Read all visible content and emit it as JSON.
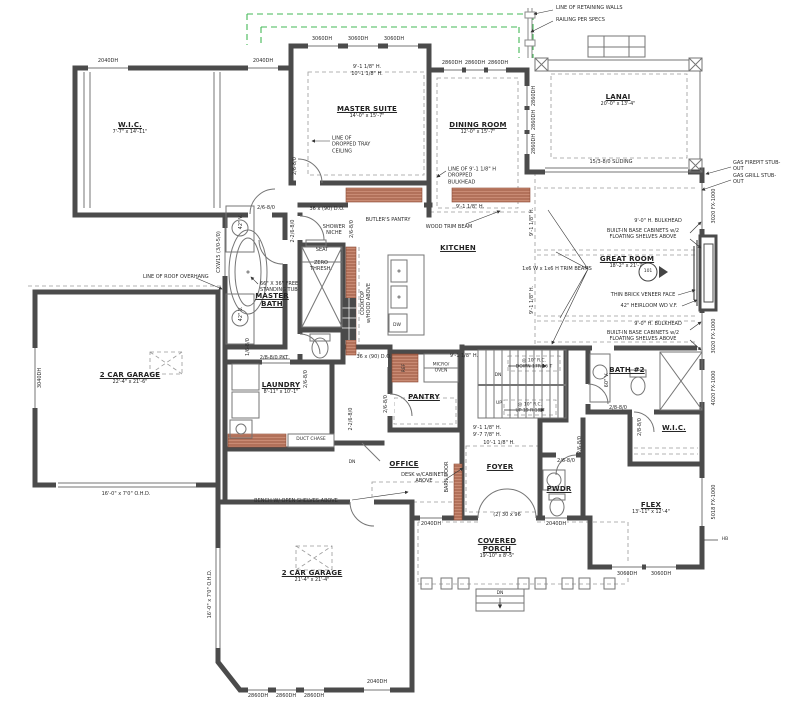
{
  "drawing": {
    "type_label": "first-floor-plan"
  },
  "colors": {
    "wall": "#4b4b4b",
    "thin": "#757575",
    "dash": "#9a9a9a",
    "green_dash": "#43b957",
    "cabinet_red": "#c98b74",
    "cabinet_red_dark": "#8e4a33"
  },
  "rooms": [
    {
      "id": "wic-1",
      "name": "W.I.C.",
      "dims": "7'-7\" x 14'-11\"",
      "x": 130,
      "y": 128
    },
    {
      "id": "master-suite",
      "name": "MASTER SUITE",
      "dims": "14'-0\" x 15'-7\"",
      "x": 367,
      "y": 112
    },
    {
      "id": "dining-room",
      "name": "DINING ROOM",
      "dims": "12'-0\" x 15'-7\"",
      "x": 478,
      "y": 128
    },
    {
      "id": "lanai",
      "name": "LANAI",
      "dims": "20'-0\" x 13'-4\"",
      "x": 618,
      "y": 100
    },
    {
      "id": "master-bath",
      "name": "MASTER\nBATH",
      "dims": "",
      "x": 272,
      "y": 300
    },
    {
      "id": "kitchen",
      "name": "KITCHEN",
      "dims": "",
      "x": 458,
      "y": 248
    },
    {
      "id": "great-room",
      "name": "GREAT ROOM",
      "dims": "18'-2\" x 21'-7\"",
      "x": 627,
      "y": 262
    },
    {
      "id": "garage-left",
      "name": "2 CAR GARAGE",
      "dims": "22'-4\" x 21'-6\"",
      "x": 130,
      "y": 378
    },
    {
      "id": "laundry",
      "name": "LAUNDRY",
      "dims": "8'-11\" x 10'-1\"",
      "x": 281,
      "y": 388
    },
    {
      "id": "pantry",
      "name": "PANTRY",
      "dims": "",
      "x": 424,
      "y": 397
    },
    {
      "id": "office",
      "name": "OFFICE",
      "dims": "",
      "x": 404,
      "y": 464
    },
    {
      "id": "foyer",
      "name": "FOYER",
      "dims": "",
      "x": 500,
      "y": 467
    },
    {
      "id": "pwdr",
      "name": "PWDR",
      "dims": "",
      "x": 559,
      "y": 489
    },
    {
      "id": "bath-2",
      "name": "BATH #2",
      "dims": "",
      "x": 627,
      "y": 370
    },
    {
      "id": "wic-2",
      "name": "W.I.C.",
      "dims": "",
      "x": 674,
      "y": 428
    },
    {
      "id": "flex",
      "name": "FLEX",
      "dims": "13'-11\" x 12'-4\"",
      "x": 651,
      "y": 508
    },
    {
      "id": "garage-bottom",
      "name": "2 CAR GARAGE",
      "dims": "21'-4\" x 21'-4\"",
      "x": 312,
      "y": 576
    },
    {
      "id": "covered-porch",
      "name": "COVERED\nPORCH",
      "dims": "19'-10\" x 8'-5\"",
      "x": 497,
      "y": 548
    }
  ],
  "annotations": [
    {
      "n": "note-retaining-walls",
      "t": "LINE OF RETAINING WALLS",
      "x": 556,
      "y": 8,
      "a": "l"
    },
    {
      "n": "note-railing",
      "t": "RAILING PER SPECS",
      "x": 556,
      "y": 20,
      "a": "l"
    },
    {
      "n": "note-gas-firepit",
      "t": "GAS FIREPIT STUB-OUT",
      "x": 733,
      "y": 166,
      "a": "l"
    },
    {
      "n": "note-gas-grill",
      "t": "GAS GRILL STUB-OUT",
      "x": 733,
      "y": 179,
      "a": "l"
    },
    {
      "n": "tag-sliding-door",
      "t": "15/3-8/0 SLIDING",
      "x": 611,
      "y": 162
    },
    {
      "n": "note-roof-overhang",
      "t": "LINE OF ROOF OVERHANG",
      "x": 143,
      "y": 277,
      "a": "l"
    },
    {
      "n": "note-tray-ceiling",
      "t": "LINE OF\nDROPPED TRAY\nCEILING",
      "x": 332,
      "y": 145,
      "a": "l"
    },
    {
      "n": "note-dropped-bulkhead",
      "t": "LINE OF 9'-1 1/8\" H\nDROPPED\nBULKHEAD",
      "x": 448,
      "y": 176,
      "a": "l"
    },
    {
      "n": "note-butlers-pantry",
      "t": "BUTLER'S PANTRY",
      "x": 388,
      "y": 220
    },
    {
      "n": "note-wood-trim-beam",
      "t": "WOOD TRIM BEAM",
      "x": 449,
      "y": 227
    },
    {
      "n": "note-shower-niche",
      "t": "SHOWER\nNICHE",
      "x": 334,
      "y": 230
    },
    {
      "n": "note-seat",
      "t": "SEAT",
      "x": 322,
      "y": 250
    },
    {
      "n": "note-zero-thresh",
      "t": "ZERO\nTHRESH.",
      "x": 321,
      "y": 266
    },
    {
      "n": "note-free-standing-tub",
      "t": "66\" X 36\" FREE\nSTANDING TUB",
      "x": 260,
      "y": 287,
      "a": "l"
    },
    {
      "n": "note-trim-beams",
      "t": "1x6 W x 1x6 H TRIM BEAMS",
      "x": 557,
      "y": 269
    },
    {
      "n": "note-bulkhead-1",
      "t": "9'-0\" H. BULKHEAD",
      "x": 658,
      "y": 221
    },
    {
      "n": "note-builtin-1",
      "t": "BUILT-IN BASE CABINETS w/2\nFLOATING SHELVES ABOVE",
      "x": 643,
      "y": 234
    },
    {
      "n": "note-thin-brick",
      "t": "THIN BRICK VENEER FACE",
      "x": 643,
      "y": 295
    },
    {
      "n": "note-heirloom-fireplace",
      "t": "42\" HEIRLOOM WD V.F.",
      "x": 649,
      "y": 306
    },
    {
      "n": "note-bulkhead-2",
      "t": "9'-0\" H. BULKHEAD",
      "x": 658,
      "y": 324
    },
    {
      "n": "note-builtin-2",
      "t": "BUILT-IN BASE CABINETS w/2\nFLOATING SHELVES ABOVE",
      "x": 643,
      "y": 336
    },
    {
      "n": "note-cooktop",
      "t": "COOKTOP\nw/HOOD ABOVE",
      "x": 366,
      "y": 303,
      "r": 1
    },
    {
      "n": "tag-dw",
      "t": "DW",
      "x": 397,
      "y": 326,
      "s": 4.5
    },
    {
      "n": "note-duct-chase",
      "t": "DUCT CHASE",
      "x": 311,
      "y": 440,
      "s": 4.5
    },
    {
      "n": "tag-ref",
      "t": "REF",
      "x": 405,
      "y": 368,
      "r": 1,
      "s": 4.5
    },
    {
      "n": "tag-micro-oven",
      "t": "MICRO/\nOVEN",
      "x": 441,
      "y": 368,
      "s": 4.5
    },
    {
      "n": "note-desk",
      "t": "DESK w/CABINETS\nABOVE",
      "x": 424,
      "y": 478
    },
    {
      "n": "note-bench",
      "t": "BENCH W/ OPEN SHELVES ABOVE",
      "x": 296,
      "y": 501
    },
    {
      "n": "note-barn-door",
      "t": "BARN DOOR",
      "x": 447,
      "y": 477,
      "r": 1
    },
    {
      "n": "tag-dn-step",
      "t": "DN",
      "x": 352,
      "y": 463,
      "s": 4.5
    },
    {
      "n": "tag-stair-dn",
      "t": "DN",
      "x": 498,
      "y": 376,
      "s": 4.5
    },
    {
      "n": "tag-stair-up",
      "t": "UP",
      "x": 499,
      "y": 404,
      "s": 4.5
    },
    {
      "n": "note-stair-down",
      "t": "@ 10\" R.C.\nDOWN 17R 16 T",
      "x": 534,
      "y": 364,
      "s": 4.5
    },
    {
      "n": "note-stair-up",
      "t": "@ 10\" R.C.\nUP 19 R 18 T",
      "x": 530,
      "y": 408,
      "s": 4.5
    },
    {
      "n": "tag-porch-dn",
      "t": "DN",
      "x": 500,
      "y": 594,
      "s": 4.5
    },
    {
      "n": "tag-hose-bib",
      "t": "HB",
      "x": 725,
      "y": 540,
      "s": 4.5
    },
    {
      "n": "tag-window-101",
      "t": "101",
      "x": 648,
      "y": 272,
      "s": 4.5
    },
    {
      "n": "height-1",
      "t": "9'-1 1/8\" H.",
      "x": 367,
      "y": 67
    },
    {
      "n": "height-2",
      "t": "10'-1 1/8\" H.",
      "x": 367,
      "y": 74
    },
    {
      "n": "height-3",
      "t": "9'-1 1/8\" H.",
      "x": 470,
      "y": 207
    },
    {
      "n": "height-4",
      "t": "9'-1 1/8\" H.",
      "x": 532,
      "y": 222,
      "r": 1
    },
    {
      "n": "height-5",
      "t": "9'-1 1/8\" H.",
      "x": 532,
      "y": 300,
      "r": 1
    },
    {
      "n": "height-6",
      "t": "9'-1 1/8\" H.",
      "x": 464,
      "y": 356
    },
    {
      "n": "height-7",
      "t": "9'-1 1/8\" H.",
      "x": 487,
      "y": 428
    },
    {
      "n": "height-8",
      "t": "9'-7 7/8\" H.",
      "x": 487,
      "y": 435
    },
    {
      "n": "height-9",
      "t": "10'-1 1/8\" H.",
      "x": 499,
      "y": 443
    },
    {
      "n": "tag-ohd-1",
      "t": "16'-0\" x 7'0\" O.H.D.",
      "x": 126,
      "y": 494
    },
    {
      "n": "tag-ohd-2",
      "t": "16'-0\" x 7'0\" O.H.D.",
      "x": 210,
      "y": 594,
      "r": 1
    },
    {
      "n": "tag-vanity-42-1",
      "t": "42\" V.",
      "x": 241,
      "y": 222,
      "r": 1
    },
    {
      "n": "tag-vanity-42-2",
      "t": "42\" V.",
      "x": 241,
      "y": 314,
      "r": 1
    },
    {
      "n": "tag-vanity-60",
      "t": "60\" V.",
      "x": 607,
      "y": 380,
      "r": 1
    },
    {
      "n": "tag-window-cxw",
      "t": "CXW15 (3/0-5/0)",
      "x": 219,
      "y": 252,
      "r": 1
    },
    {
      "n": "win-2040-a",
      "t": "2040DH",
      "x": 108,
      "y": 61
    },
    {
      "n": "win-2040-b",
      "t": "2040DH",
      "x": 263,
      "y": 61
    },
    {
      "n": "win-3060-a",
      "t": "3060DH",
      "x": 322,
      "y": 39
    },
    {
      "n": "win-3060-b",
      "t": "3060DH",
      "x": 358,
      "y": 39
    },
    {
      "n": "win-3060-c",
      "t": "3060DH",
      "x": 394,
      "y": 39
    },
    {
      "n": "win-2860-a",
      "t": "2860DH",
      "x": 452,
      "y": 63
    },
    {
      "n": "win-2860-b",
      "t": "2860DH",
      "x": 475,
      "y": 63
    },
    {
      "n": "win-2860-c",
      "t": "2860DH",
      "x": 498,
      "y": 63
    },
    {
      "n": "win-2860-d",
      "t": "2860DH",
      "x": 534,
      "y": 96,
      "r": 1
    },
    {
      "n": "win-2860-e",
      "t": "2860DH",
      "x": 534,
      "y": 120,
      "r": 1
    },
    {
      "n": "win-2860-f",
      "t": "2860DH",
      "x": 534,
      "y": 144,
      "r": 1
    },
    {
      "n": "win-3040",
      "t": "3040DH",
      "x": 40,
      "y": 378,
      "r": 1
    },
    {
      "n": "win-2040-c",
      "t": "2040DH",
      "x": 431,
      "y": 524
    },
    {
      "n": "win-2040-d",
      "t": "2040DH",
      "x": 556,
      "y": 524
    },
    {
      "n": "door-front",
      "t": "(2) 30 x 96",
      "x": 507,
      "y": 515
    },
    {
      "n": "win-2040-e",
      "t": "2040DH",
      "x": 377,
      "y": 682
    },
    {
      "n": "win-2860-g",
      "t": "2860DH",
      "x": 258,
      "y": 696
    },
    {
      "n": "win-2860-h",
      "t": "2860DH",
      "x": 286,
      "y": 696
    },
    {
      "n": "win-2860-i",
      "t": "2860DH",
      "x": 314,
      "y": 696
    },
    {
      "n": "win-3060-d",
      "t": "3060DH",
      "x": 627,
      "y": 574
    },
    {
      "n": "win-3060-e",
      "t": "3060DH",
      "x": 661,
      "y": 574
    },
    {
      "n": "win-3020-fx-1",
      "t": "3020 FX-1000",
      "x": 714,
      "y": 206,
      "r": 1
    },
    {
      "n": "win-3020-fx-2",
      "t": "3020 FX-1000",
      "x": 714,
      "y": 336,
      "r": 1
    },
    {
      "n": "win-4020-fx",
      "t": "4020 FX-1000",
      "x": 714,
      "y": 388,
      "r": 1
    },
    {
      "n": "win-5018-fx",
      "t": "5018 FX-1000",
      "x": 714,
      "y": 502,
      "r": 1
    },
    {
      "n": "door-wic1",
      "t": "2/6-8/0",
      "x": 266,
      "y": 208
    },
    {
      "n": "door-hall-1",
      "t": "2-2/6-8/0",
      "x": 293,
      "y": 231,
      "r": 1
    },
    {
      "n": "door-hall-2",
      "t": "2/6-8/0",
      "x": 352,
      "y": 229,
      "r": 1
    },
    {
      "n": "door-butler-opening",
      "t": "36 x (90) D.O.",
      "x": 327,
      "y": 209
    },
    {
      "n": "door-mud-opening",
      "t": "36 x (90) D.O.",
      "x": 374,
      "y": 357
    },
    {
      "n": "door-laundry-pkt",
      "t": "2/8-8/0 PKT",
      "x": 274,
      "y": 358
    },
    {
      "n": "door-wc",
      "t": "1/6-8/0",
      "x": 248,
      "y": 347,
      "r": 1
    },
    {
      "n": "door-laundry",
      "t": "2/6-8/0",
      "x": 306,
      "y": 379,
      "r": 1
    },
    {
      "n": "door-mud",
      "t": "2-2/6-8/0",
      "x": 351,
      "y": 419,
      "r": 1
    },
    {
      "n": "door-pantry",
      "t": "2/6-8/0",
      "x": 386,
      "y": 404,
      "r": 1
    },
    {
      "n": "door-bath2-a",
      "t": "2/8-8/0",
      "x": 618,
      "y": 408
    },
    {
      "n": "door-bath2-b",
      "t": "2/8-8/0",
      "x": 640,
      "y": 427,
      "r": 1
    },
    {
      "n": "door-pwdr-a",
      "t": "2/6-8/0",
      "x": 566,
      "y": 461
    },
    {
      "n": "door-pwdr-b",
      "t": "2/6-8/0",
      "x": 580,
      "y": 445,
      "r": 1
    },
    {
      "n": "door-master",
      "t": "2/6-8/0",
      "x": 295,
      "y": 166,
      "r": 1
    }
  ]
}
